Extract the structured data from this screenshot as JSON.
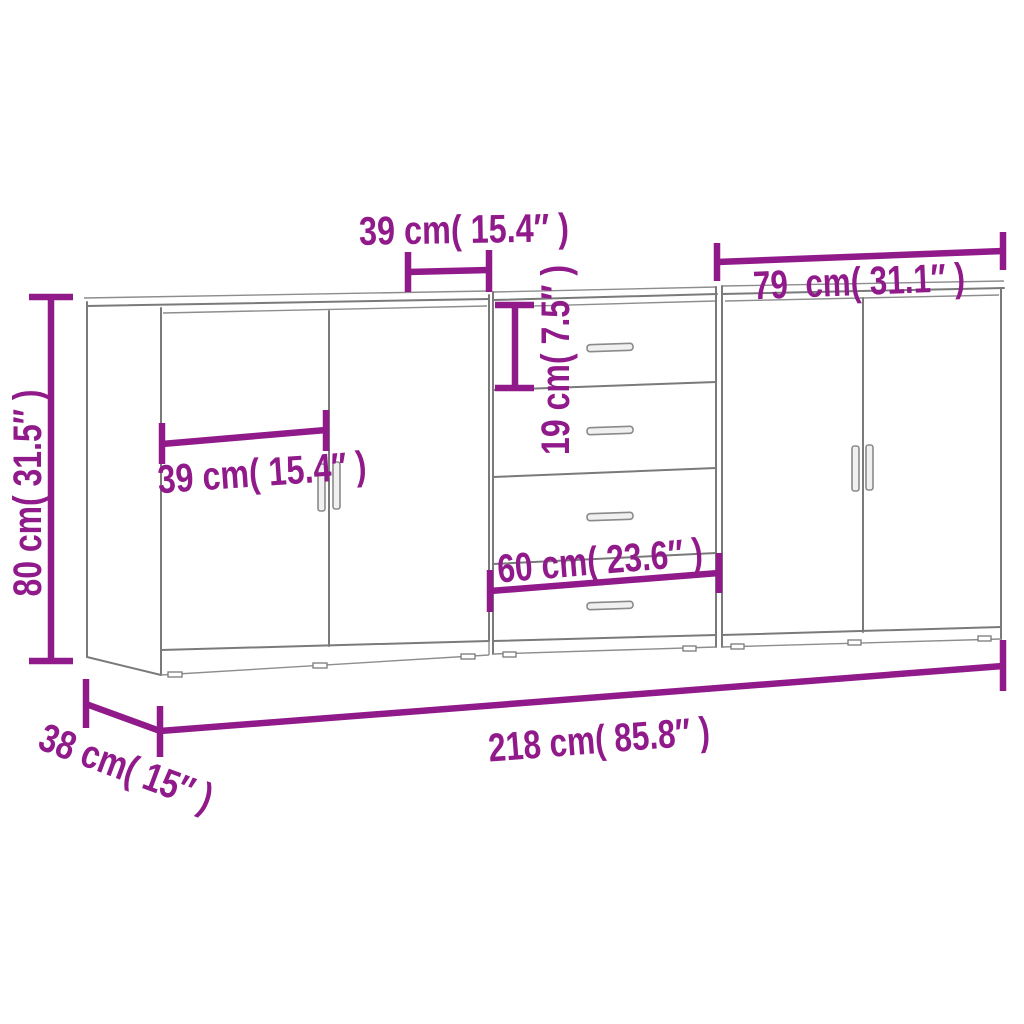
{
  "diagram": {
    "kind": "product-dimension-diagram",
    "subject": "three sideboards (two door cabinets and one four-drawer cabinet) line drawing",
    "background_color": "#ffffff",
    "outline_color": "#7a7a7a",
    "annotation_color": "#911a8b"
  },
  "labels": {
    "top_section_width": "39 cm( 15.4″ )",
    "right_section_width": "79  cm( 31.1″ )",
    "overall_height": "80 cm( 31.5″ )",
    "left_door_width": "39 cm( 15.4″ )",
    "drawer_height": "19 cm( 7.5″ )",
    "middle_section_width": "60 cm( 23.6″ )",
    "overall_width": "218 cm( 85.8″ )",
    "overall_depth": "38 cm( 15″ )"
  },
  "measurements": [
    {
      "id": "top_section_width",
      "cm": 39,
      "inches": 15.4,
      "label": "39 cm( 15.4″ )",
      "applies_to": "middle cabinet left door width (top arrow)"
    },
    {
      "id": "right_section_width",
      "cm": 79,
      "inches": 31.1,
      "label": "79  cm( 31.1″ )",
      "applies_to": "right cabinet width"
    },
    {
      "id": "overall_height",
      "cm": 80,
      "inches": 31.5,
      "label": "80 cm( 31.5″ )",
      "applies_to": "cabinet height"
    },
    {
      "id": "left_door_width",
      "cm": 39,
      "inches": 15.4,
      "label": "39 cm( 15.4″ )",
      "applies_to": "left cabinet door width"
    },
    {
      "id": "drawer_height",
      "cm": 19,
      "inches": 7.5,
      "label": "19 cm( 7.5″ )",
      "applies_to": "top drawer height"
    },
    {
      "id": "middle_section_width",
      "cm": 60,
      "inches": 23.6,
      "label": "60 cm( 23.6″ )",
      "applies_to": "middle drawer cabinet width"
    },
    {
      "id": "overall_width",
      "cm": 218,
      "inches": 85.8,
      "label": "218 cm( 85.8″ )",
      "applies_to": "total width of all three cabinets"
    },
    {
      "id": "overall_depth",
      "cm": 38,
      "inches": 15,
      "label": "38 cm( 15″ )",
      "applies_to": "cabinet depth"
    }
  ]
}
